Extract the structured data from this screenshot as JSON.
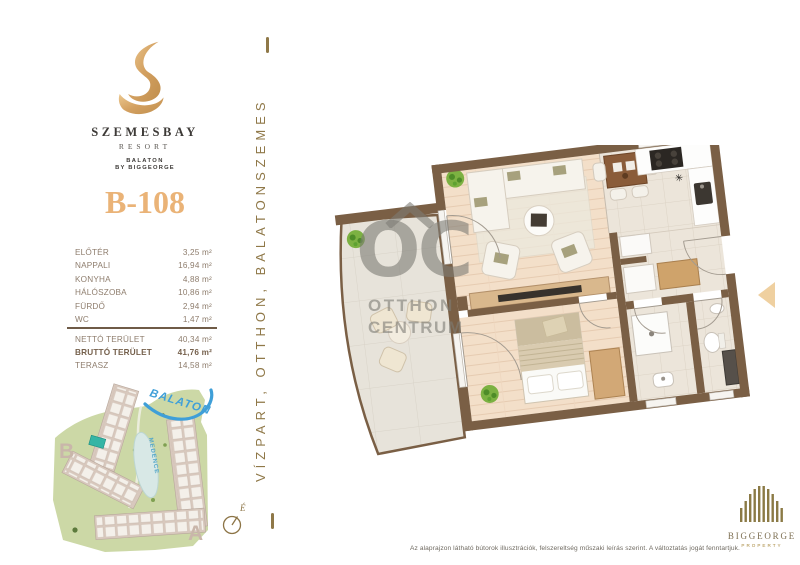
{
  "brand": {
    "name": "SZEMESBAY",
    "subtitle": "RESORT",
    "tagline1": "BALATON",
    "tagline2": "BY BIGGEORGE"
  },
  "unit_id": "B-108",
  "room_list": {
    "rooms": [
      {
        "label": "ELŐTÉR",
        "area": "3,25 m²"
      },
      {
        "label": "NAPPALI",
        "area": "16,94 m²"
      },
      {
        "label": "KONYHA",
        "area": "4,88 m²"
      },
      {
        "label": "HÁLÓSZOBA",
        "area": "10,86 m²"
      },
      {
        "label": "FÜRDŐ",
        "area": "2,94 m²"
      },
      {
        "label": "WC",
        "area": "1,47 m²"
      }
    ],
    "totals": [
      {
        "label": "NETTÓ TERÜLET",
        "area": "40,34 m²"
      },
      {
        "label": "BRUTTÓ TERÜLET",
        "area": "41,76 m²"
      },
      {
        "label": "TERASZ",
        "area": "14,58 m²"
      }
    ]
  },
  "side_banner": {
    "text": "VÍZPART, OTTHON, BALATONSZEMES"
  },
  "site_map": {
    "lake": "BALATON",
    "pool": "MEDENCE",
    "block_b": "B",
    "block_a": "A"
  },
  "compass": {
    "north": "É"
  },
  "watermark": {
    "monogram": "OC",
    "line1": "OTTHON",
    "line2": "CENTRUM"
  },
  "floor_plan": {
    "freezer_symbol": "✳"
  },
  "footer": {
    "disclaimer": "Az alaprajzon látható bútorok illusztrációk, felszereltség műszaki leírás szerint. A változtatás jogát fenntartjuk.",
    "brand": "BIGGEORGE",
    "brand_sub": "PROPERTY"
  },
  "colors": {
    "gold": "#eab377",
    "logo_gold": "#d3a060",
    "wall_brown": "#7a5f45",
    "list_text": "#8e7d6d",
    "side_text": "#8f7848",
    "map_green": "#ccd8a6",
    "lake_blue": "#3f9fd8",
    "highlight_teal": "#35b5a5"
  }
}
